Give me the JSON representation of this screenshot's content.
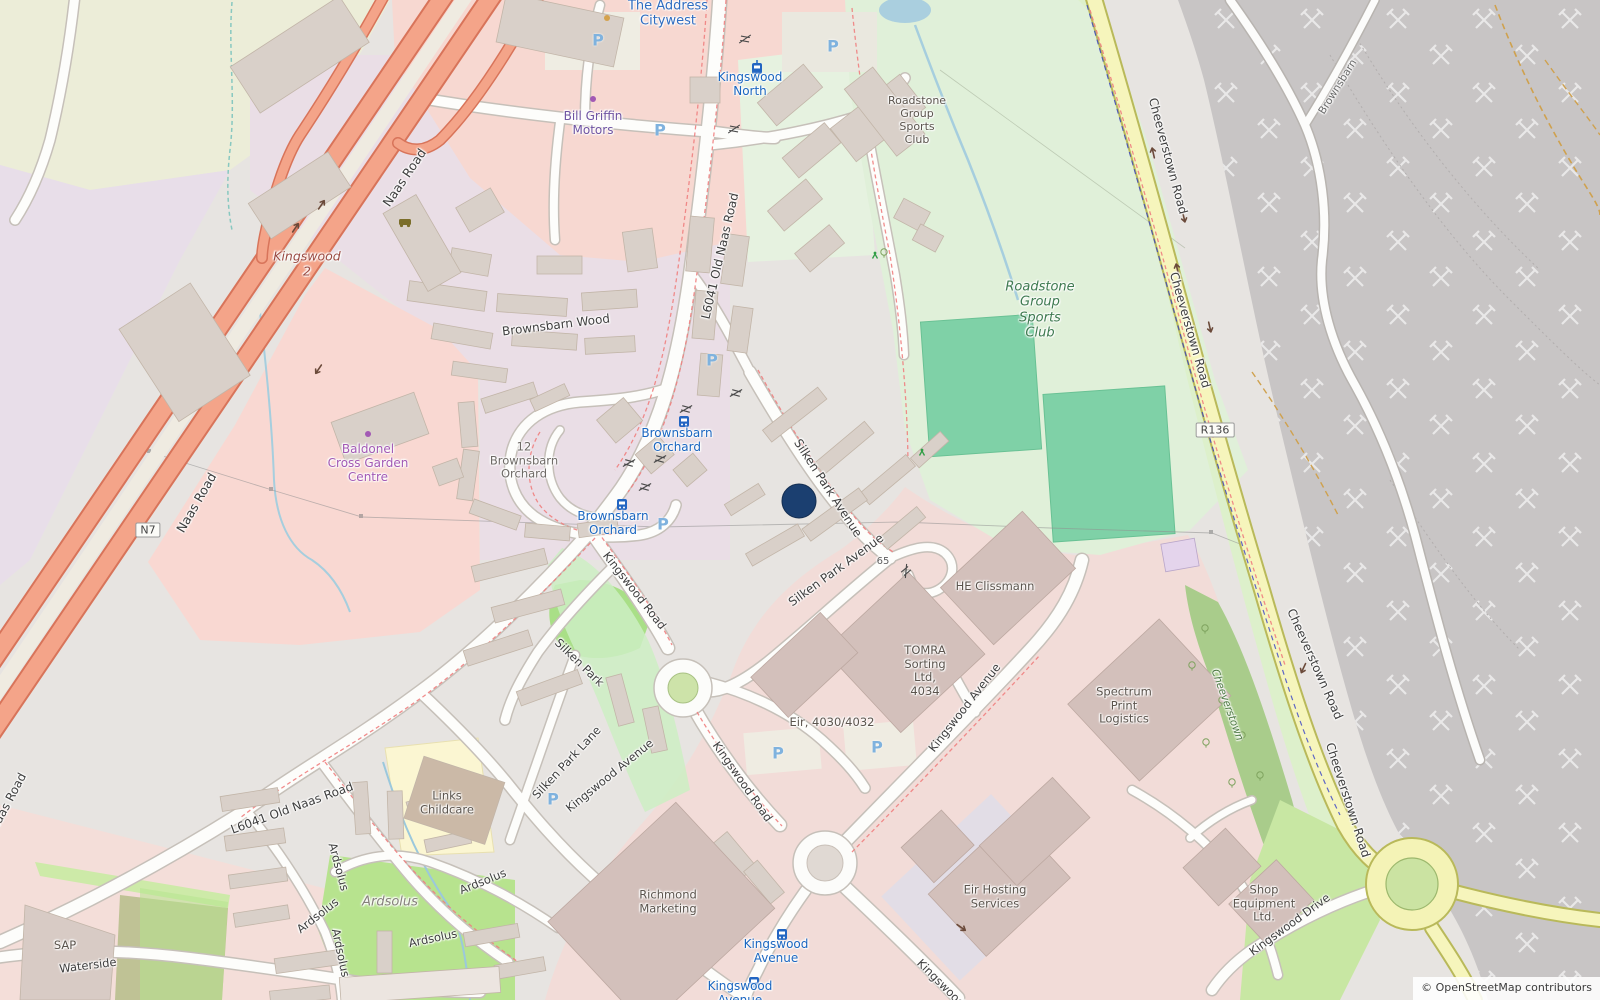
{
  "attribution": "© OpenStreetMap contributors",
  "marker": {
    "color": "#1b3f70"
  },
  "shields": {
    "n7": "N7",
    "r136": "R136"
  },
  "icons": {
    "parking": "P",
    "tram_stop": "tram-icon",
    "bus_stop": "bus-icon",
    "quarry_symbol": "crossed-hammers",
    "playground": "playground-icon",
    "car_dealer": "car-icon",
    "shop_node": "purple-dot"
  },
  "palette": {
    "trunk_road": "#f4a489",
    "secondary_road": "#f6f5bc",
    "minor_road": "#fdfdfb",
    "quarry": "#c8c5c5",
    "sports_grounds": "#e0f0d9",
    "pitch": "#7fd1a7",
    "industrial_pink": "#f2dcd8",
    "retail_pink": "#f7d8d1",
    "residential_gray": "#e7e4e1",
    "water": "#a6cede",
    "building": "#d9d0c9"
  },
  "labels": {
    "the_address_citywest": "The Address\nCitywest",
    "kingswood_north": "Kingswood\nNorth",
    "bill_griffin_motors": "Bill Griffin\nMotors",
    "roadstone_club_building": "Roadstone\nGroup\nSports\nClub",
    "roadstone_club_grounds": "Roadstone\nGroup\nSports\nClub",
    "kingswood_2": "Kingswood\n2",
    "naas_road_upper": "Naas Road",
    "naas_road_mid": "Naas Road",
    "naas_road_edge": "Naas Road",
    "brownsbarn_wood": "Brownsbarn Wood",
    "old_naas_road_upper": "L6041  Old Naas Road",
    "old_naas_road_lower": "L6041   Old Naas Road",
    "brownsbarn_orchard_estate": "12\nBrownsbarn\nOrchard",
    "brownsbarn_orchard_stop_north": "Brownsbarn\nOrchard",
    "brownsbarn_orchard_stop_south": "Brownsbarn\nOrchard",
    "baldonel_cross_garden_centre": "Baldonel\nCross Garden\nCentre",
    "silken_park_avenue_upper": "Silken Park Avenue",
    "silken_park_avenue_lower": "Silken Park Avenue",
    "house_65": "65",
    "he_clissmann": "HE Clissmann",
    "tomra": "TOMRA\nSorting\nLtd,\n4034",
    "eir_4030": "Eir, 4030/4032",
    "spectrum_print": "Spectrum\nPrint\nLogistics",
    "cheeverstown_road_1": "Cheeverstown Road",
    "cheeverstown_road_2": "Cheeverstown Road",
    "cheeverstown_road_3": "Cheeverstown Road",
    "cheeverstown_road_4": "Cheeverstown Road",
    "cheeverstown_wood": "Cheeverstown",
    "brownsbarn_quarry_road": "Brownsbarn",
    "kingswood_road_upper": "Kingswood Road",
    "kingswood_road_lower": "Kingswood Road",
    "kingswood_road_bottom": "Kingswood Road",
    "silken_park": "Silken Park",
    "silken_park_lane": "Silken Park Lane",
    "kingswood_avenue_west": "Kingswood Avenue",
    "kingswood_avenue_east": "Kingswood Avenue",
    "links_childcare": "Links\nChildcare",
    "ardsolus_1": "Ardsolus",
    "ardsolus_2": "Ardsolus",
    "ardsolus_3": "Ardsolus",
    "ardsolus_4": "Ardsolus",
    "ardsolus_5": "Ardsolus",
    "ardsolus_estate": "Ardsolus",
    "waterside": "Waterside",
    "sap": "SAP",
    "richmond_marketing": "Richmond\nMarketing",
    "kingswood_avenue_stop_north": "Kingswood\nAvenue",
    "kingswood_avenue_stop_south": "Kingswood\nAvenue",
    "eir_hosting_services": "Eir Hosting\nServices",
    "shop_equipment": "Shop\nEquipment\nLtd.",
    "kingswood_drive": "Kingswood Drive"
  }
}
